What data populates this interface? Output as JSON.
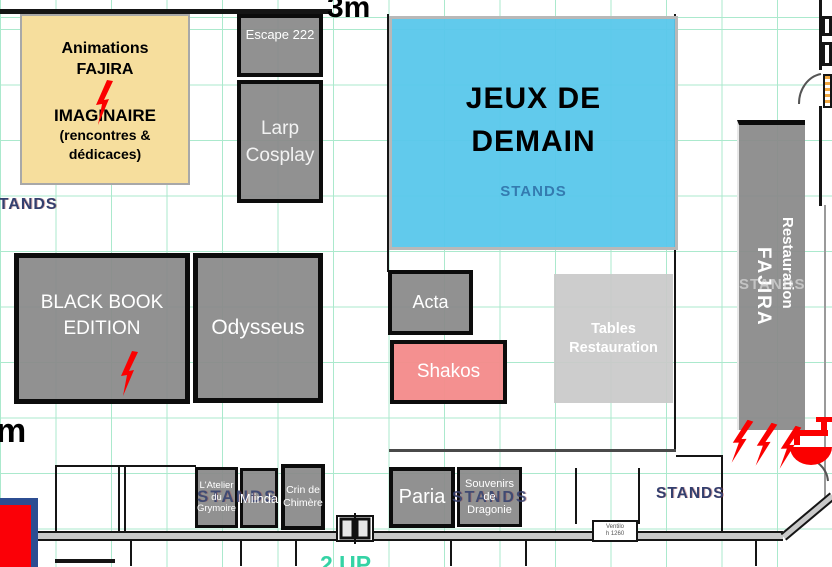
{
  "canvas": {
    "width": 832,
    "height": 567
  },
  "labels": {
    "top_measure": "3m",
    "left_measure": "m",
    "up_label": "2 UP",
    "ventilo_line1": "Ventilo",
    "ventilo_line2": "h 1260"
  },
  "stands": {
    "left": "STANDS",
    "bottom_left": "STANDS",
    "bottom_mid": "STANDS",
    "bottom_right": "STANDS",
    "behind_resto": "STANDS"
  },
  "zones": {
    "animations": {
      "line1": "Animations",
      "line2": "FAJIRA",
      "line3": "IMAGINAIRE",
      "line4": "(rencontres &",
      "line5": "dédicaces)"
    },
    "escape": {
      "label": "Escape 222"
    },
    "larp": {
      "line1": "Larp",
      "line2": "Cosplay"
    },
    "jeux": {
      "line1": "JEUX DE",
      "line2": "DEMAIN",
      "sub": "STANDS"
    },
    "black_book": {
      "line1": "BLACK BOOK",
      "line2": "EDITION"
    },
    "odysseus": {
      "label": "Odysseus"
    },
    "acta": {
      "label": "Acta"
    },
    "shakos": {
      "label": "Shakos"
    },
    "tables": {
      "line1": "Tables",
      "line2": "Restauration"
    },
    "restauration": {
      "line1": "Restauration",
      "line2": "FAJIRA"
    },
    "atelier": {
      "line1": "L'Atelier",
      "line2": "du",
      "line3": "Grymoire"
    },
    "miinda": {
      "label": "Miinda"
    },
    "crin": {
      "line1": "Crin de",
      "line2": "Chimère"
    },
    "paria": {
      "label": "Paria"
    },
    "souvenirs": {
      "line1": "Souvenirs",
      "line2": "de",
      "line3": "Dragonie"
    }
  },
  "icons": {
    "lightning": "lightning-icon",
    "sink": "sink-icon"
  },
  "colors": {
    "yellow_zone": "#F6DE9D",
    "blue_zone": "#58C7EB",
    "gray_zone": "#8A8A8A",
    "light_gray_zone": "#C9C9C9",
    "pink_zone": "#F48B8B",
    "stands_text": "#333F6E",
    "hazard_red": "#FB0000",
    "grid_green": "#A8E8CB",
    "teal_text": "#35D3A5"
  }
}
